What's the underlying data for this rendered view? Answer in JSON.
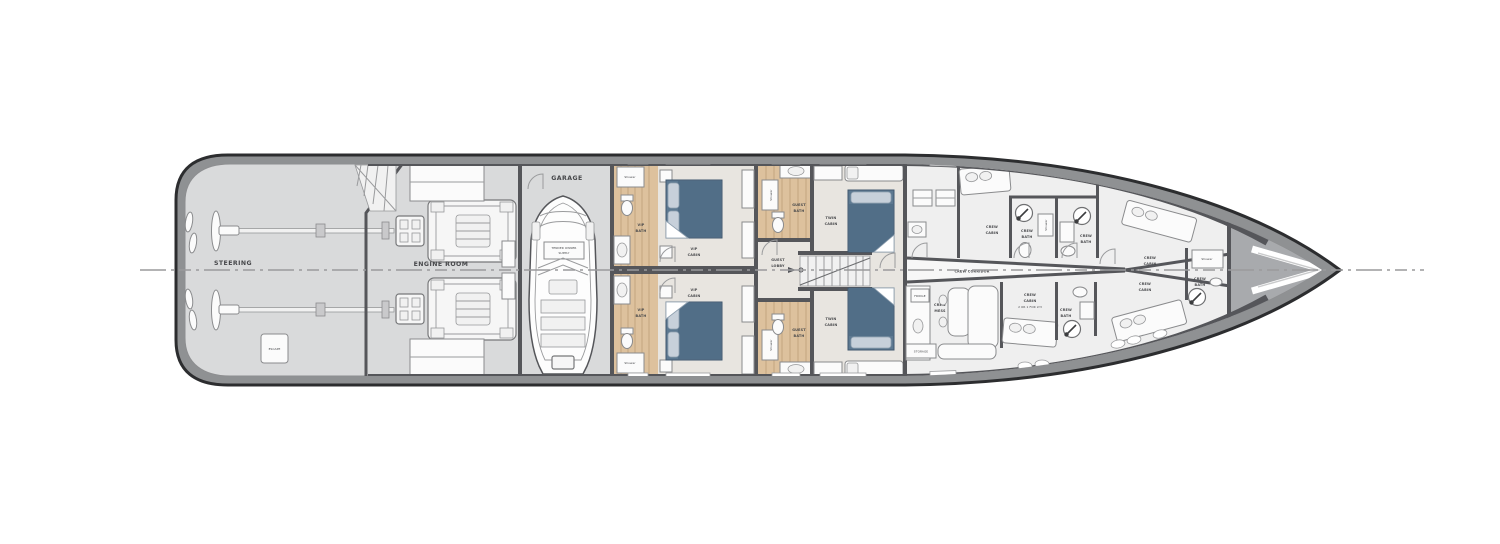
{
  "colors": {
    "hull_outline": "#2c2d2f",
    "band_gray": "#8f9193",
    "wall": "#55565a",
    "floor_gray": "#d9dadb",
    "floor_beige": "#e8e5e0",
    "crew_floor": "#efefef",
    "bow_gray": "#a8aaad",
    "wood": "#ddc19d",
    "bed_blue": "#5d7991",
    "bed_blue_dark": "#52688",
    "label": "#46474a"
  },
  "labels": {
    "steering": "STEERING",
    "escape": "ESCAPE",
    "engine_room": "ENGINE ROOM",
    "garage": "GARAGE",
    "tender_l1": "TENDER OWNER",
    "tender_l2": "SUPPLY",
    "vip_bath_l1": "VIP",
    "vip_bath_l2": "BATH",
    "vip_cabin_l1": "VIP",
    "vip_cabin_l2": "CABIN",
    "guest_bath_l1": "GUEST",
    "guest_bath_l2": "BATH",
    "guest_lobby_l1": "GUEST",
    "guest_lobby_l2": "LOBBY",
    "twin_cabin_l1": "TWIN",
    "twin_cabin_l2": "CABIN",
    "shower": "Shower",
    "fridge": "FRIDGE",
    "storage": "STORAGE",
    "crew_mess_l1": "CREW",
    "crew_mess_l2": "MESS",
    "crew_corridor": "CREW CORRIDOR",
    "crew_l1": "CREW",
    "crew_cabin_l2": "CABIN",
    "crew_bath_l2": "BATH",
    "crew_cabin_note": "2 OR 1 FOR LY3"
  }
}
